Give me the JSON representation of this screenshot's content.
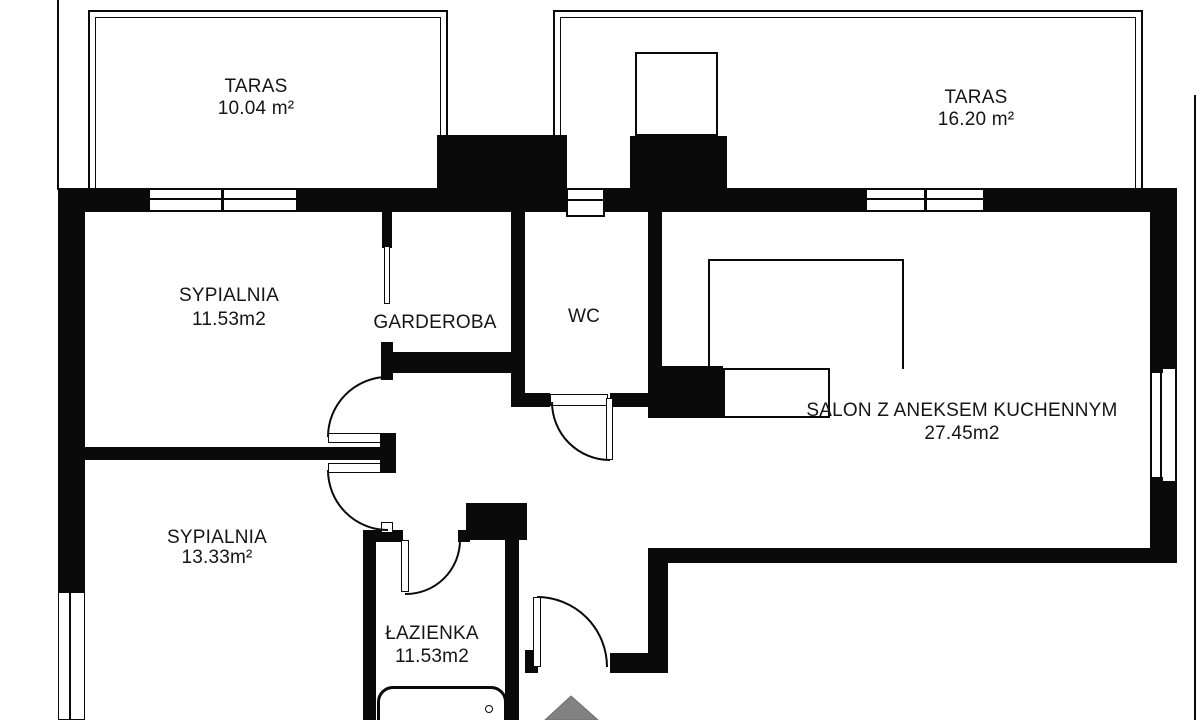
{
  "plan": {
    "title": "apartment-floor-plan",
    "rooms": [
      {
        "name": "TARAS",
        "area": "10.04 m²"
      },
      {
        "name": "TARAS",
        "area": "16.20 m²"
      },
      {
        "name": "SYPIALNIA",
        "area": "11.53m2"
      },
      {
        "name": "GARDEROBA",
        "area": ""
      },
      {
        "name": "WC",
        "area": ""
      },
      {
        "name": "SALON Z ANEKSEM KUCHENNYM",
        "area": "27.45m2"
      },
      {
        "name": "SYPIALNIA",
        "area": "13.33m²"
      },
      {
        "name": "ŁAZIENKA",
        "area": "11.53m2"
      }
    ],
    "colors": {
      "wall": "#0a0a0a",
      "background": "#ffffff",
      "entrance_marker": "#828282"
    }
  }
}
